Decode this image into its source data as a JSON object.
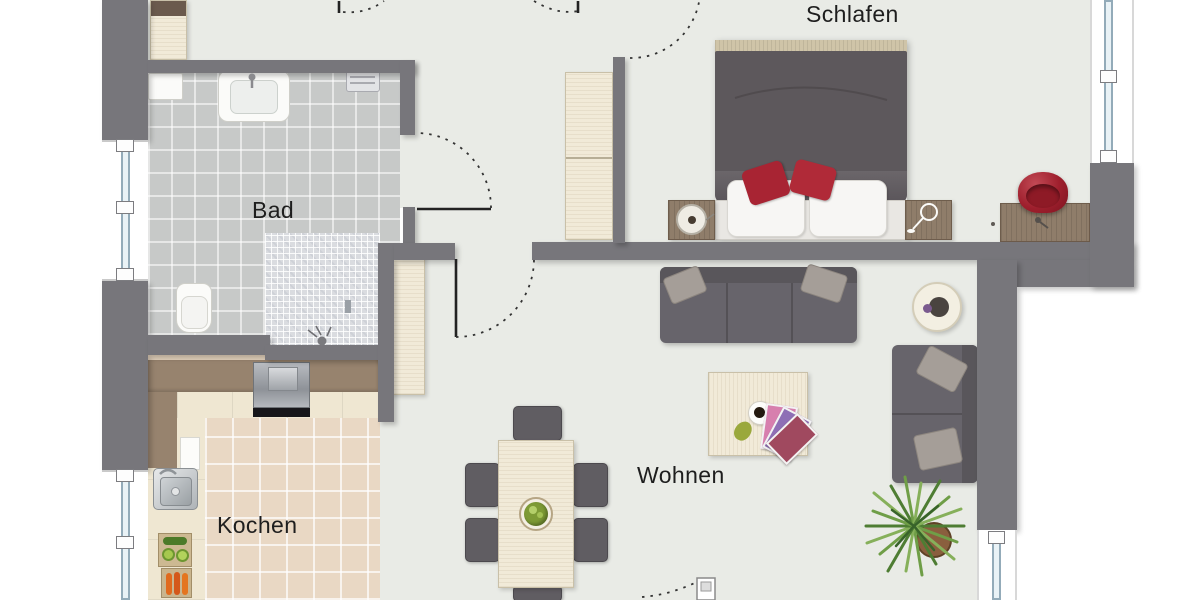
{
  "plan_title": "apartment-floor-plan",
  "rooms": {
    "bedroom": {
      "label": "Schlafen"
    },
    "bathroom": {
      "label": "Bad"
    },
    "kitchen": {
      "label": "Kochen"
    },
    "living": {
      "label": "Wohnen"
    }
  },
  "colors": {
    "wall": "#77767b",
    "floor": "#e9ebe6",
    "bathroom_tile": "#c7c9c8",
    "shower_mosaic": "#dadce0",
    "kitchen_tile": "#e9d8c4",
    "wood_light": "#f1ead8",
    "wood_brown": "#8f7d6a",
    "sofa_gray": "#67646b",
    "accent_red_pillow": "#a82433",
    "accent_red_bowl": "#9e1f2d",
    "window_glass": "#e9f2f6",
    "plant_green": "#6f9e47"
  },
  "furniture": [
    "double-bed",
    "nightstand-left",
    "nightstand-right",
    "dresser",
    "red-bowl",
    "wardrobe-hall",
    "tall-cabinet",
    "sofa-horizontal",
    "sofa-vertical",
    "side-table-round",
    "coffee-table",
    "plant",
    "dining-table",
    "dining-chairs",
    "kitchen-counter",
    "stove",
    "kitchen-sink",
    "cutting-board-cucumber",
    "cutting-board-carrots",
    "bath-sink",
    "toilet",
    "shower",
    "towel-radiator",
    "washing-machine"
  ],
  "openings": {
    "doors": [
      "bathroom-door",
      "living-room-door",
      "bedroom-door",
      "entry-door",
      "storage-door",
      "balcony-door"
    ],
    "windows": [
      "window-left-upper",
      "window-left-lower",
      "window-bedroom-right",
      "window-living-bottom"
    ]
  }
}
